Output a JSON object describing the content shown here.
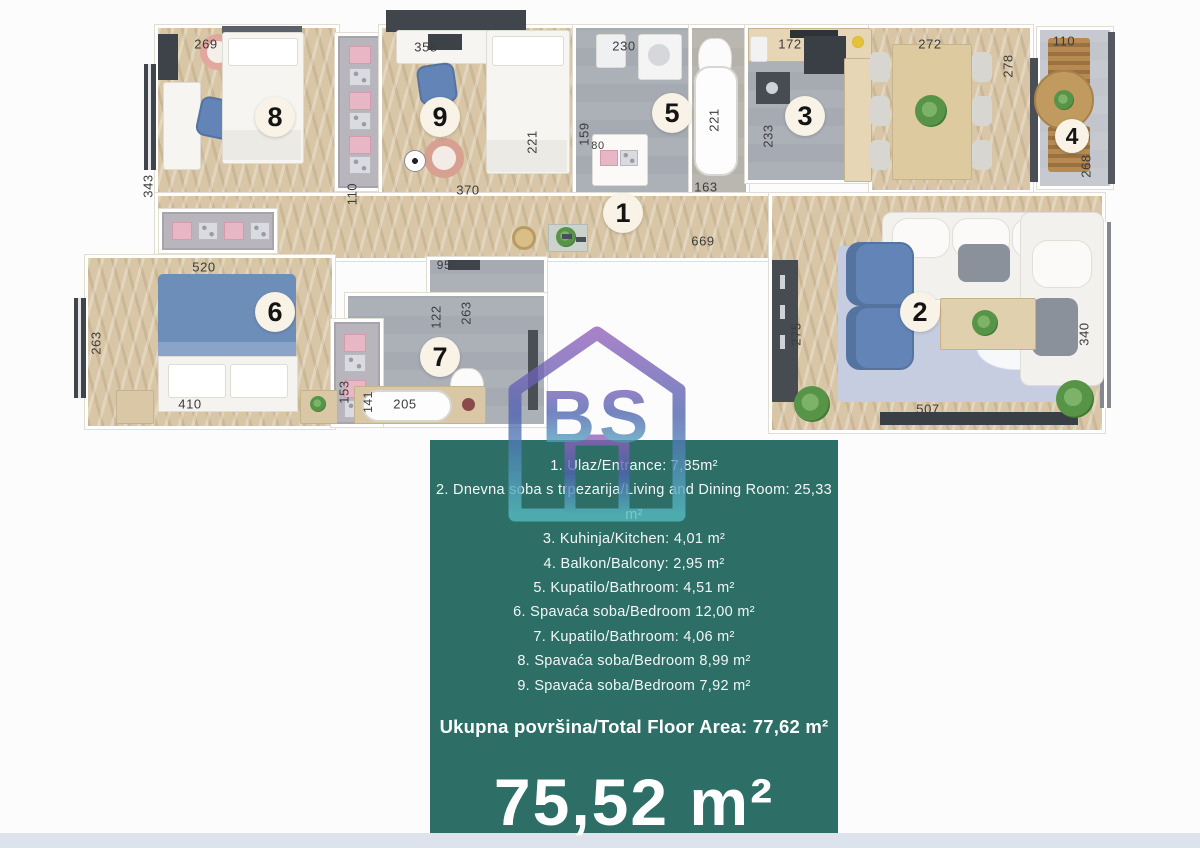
{
  "logo": {
    "text": "BS"
  },
  "panel": {
    "legend": [
      "1. Ulaz/Entrance: 7,85m²",
      "2. Dnevna soba s trpezarija/Living and Dining Room: 25,33 m²",
      "3. Kuhinja/Kitchen: 4,01 m²",
      "4. Balkon/Balcony: 2,95 m²",
      "5. Kupatilo/Bathroom: 4,51 m²",
      "6. Spavaća soba/Bedroom 12,00 m²",
      "7. Kupatilo/Bathroom: 4,06 m²",
      "8. Spavaća soba/Bedroom 8,99 m²",
      "9. Spavaća soba/Bedroom 7,92 m²"
    ],
    "total_label": "Ukupna površina/Total Floor Area: 77,62 m²",
    "total_value": "75,52 m²"
  },
  "badges": {
    "b1": "1",
    "b2": "2",
    "b3": "3",
    "b4": "4",
    "b5": "5",
    "b6": "6",
    "b7": "7",
    "b8": "8",
    "b9": "9"
  },
  "dims": {
    "r8_top": "269",
    "r8_left": "343",
    "ward89": "110",
    "r9_top": "358",
    "r9_bed": "221",
    "r9_bottom": "370",
    "r5_top": "230",
    "r5_left": "159",
    "r5_closet": "80",
    "wc_tub": "221",
    "wc_bottom": "163",
    "kitchen_top": "172",
    "kitchen_left": "233",
    "dining_top": "272",
    "dining_right": "278",
    "balcony_top": "110",
    "balcony_right": "268",
    "hall": "669",
    "r6_top": "520",
    "r6_left": "263",
    "r6_bottom": "410",
    "r6_ward": "153",
    "r7_top": "95",
    "r7_v1": "122",
    "r7_v2": "263",
    "r7_bottom": "205",
    "r7_v3": "141",
    "lr_left": "275",
    "lr_right": "340",
    "lr_bottom": "507"
  },
  "colors": {
    "panel_bg": "#2d6e66",
    "wood": "#d8c6a6",
    "bath_floor": "#a6aab2",
    "furniture_blue": "#6384b6",
    "accent_pink": "#e8b7c6",
    "wall_dark": "#40454c",
    "badge_bg": "#f8f3e6",
    "footer_strip": "#dde3ed"
  }
}
